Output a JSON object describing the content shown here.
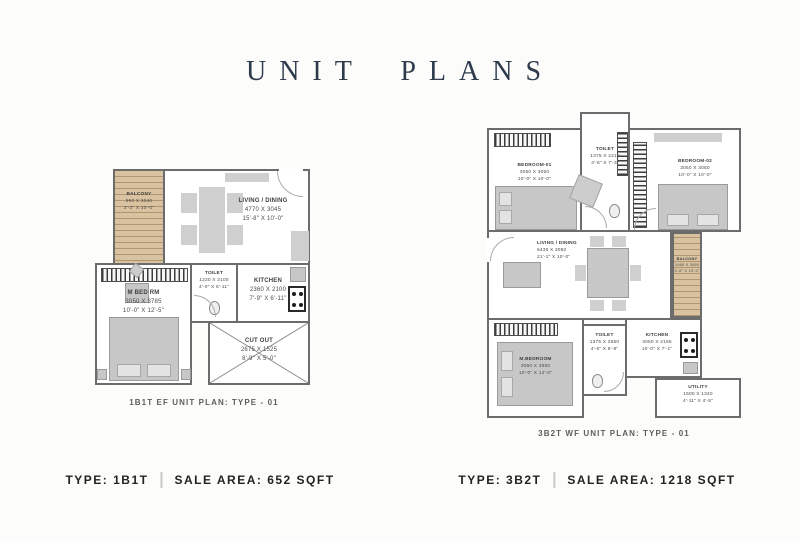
{
  "page": {
    "title": "UNIT PLANS",
    "accent_color": "#2d3b4d",
    "background_color": "#fcfcfa"
  },
  "plan_left": {
    "caption": "1B1T EF UNIT PLAN: TYPE - 01",
    "rooms": {
      "balcony": {
        "name": "BALCONY",
        "mm": "990 X 3040",
        "ft": "3'-3\" X 10'-0\""
      },
      "living": {
        "name": "LIVING / DINING",
        "mm": "4770 X 3045",
        "ft": "15'-8\" X 10'-0\""
      },
      "mbed": {
        "name": "M BED RM",
        "mm": "3050 X 3785",
        "ft": "10'-0\" X 12'-5\""
      },
      "toilet": {
        "name": "TOILET",
        "mm": "1220 X 2100",
        "ft": "4'-0\" X 6'-11\""
      },
      "kitchen": {
        "name": "KITCHEN",
        "mm": "2360 X 2100",
        "ft": "7'-9\" X 6'-11\""
      },
      "cutout": {
        "name": "CUT OUT",
        "mm": "2675 X 1525",
        "ft": "8'-9\" X 5'-0\""
      }
    }
  },
  "plan_right": {
    "caption": "3B2T WF UNIT PLAN: TYPE - 01",
    "rooms": {
      "bedroom1": {
        "name": "BEDROOM-01",
        "mm": "3050 X 3050",
        "ft": "10'-0\" X 10'-0\""
      },
      "toilet_top": {
        "name": "TOILET",
        "mm": "1375 X 2210",
        "ft": "4'-6\" X 7'-3\""
      },
      "bedroom2": {
        "name": "BEDROOM-02",
        "mm": "3050 X 3050",
        "ft": "10'-0\" X 10'-0\""
      },
      "living": {
        "name": "LIVING / DINING",
        "mm": "6435 X 3050",
        "ft": "21'-1\" X 10'-0\""
      },
      "balcony": {
        "name": "BALCONY",
        "mm": "1060 X 3050",
        "ft": "3'-6\" X 10'-0\""
      },
      "mbedroom": {
        "name": "M.BEDROOM",
        "mm": "3050 X 3650",
        "ft": "10'-0\" X 12'-0\""
      },
      "toilet_bottom": {
        "name": "TOILET",
        "mm": "1375 X 2650",
        "ft": "4'-6\" X 8'-8\""
      },
      "kitchen": {
        "name": "KITCHEN",
        "mm": "3050 X 2155",
        "ft": "10'-0\" X 7'-1\""
      },
      "utility": {
        "name": "UTILITY",
        "mm": "1500 X 1340",
        "ft": "4'-11\" X 4'-5\""
      }
    }
  },
  "footer": {
    "left": {
      "type_label": "TYPE: 1B1T",
      "area_label": "SALE AREA: 652 SQFT"
    },
    "right": {
      "type_label": "TYPE: 3B2T",
      "area_label": "SALE AREA: 1218 SQFT"
    }
  }
}
